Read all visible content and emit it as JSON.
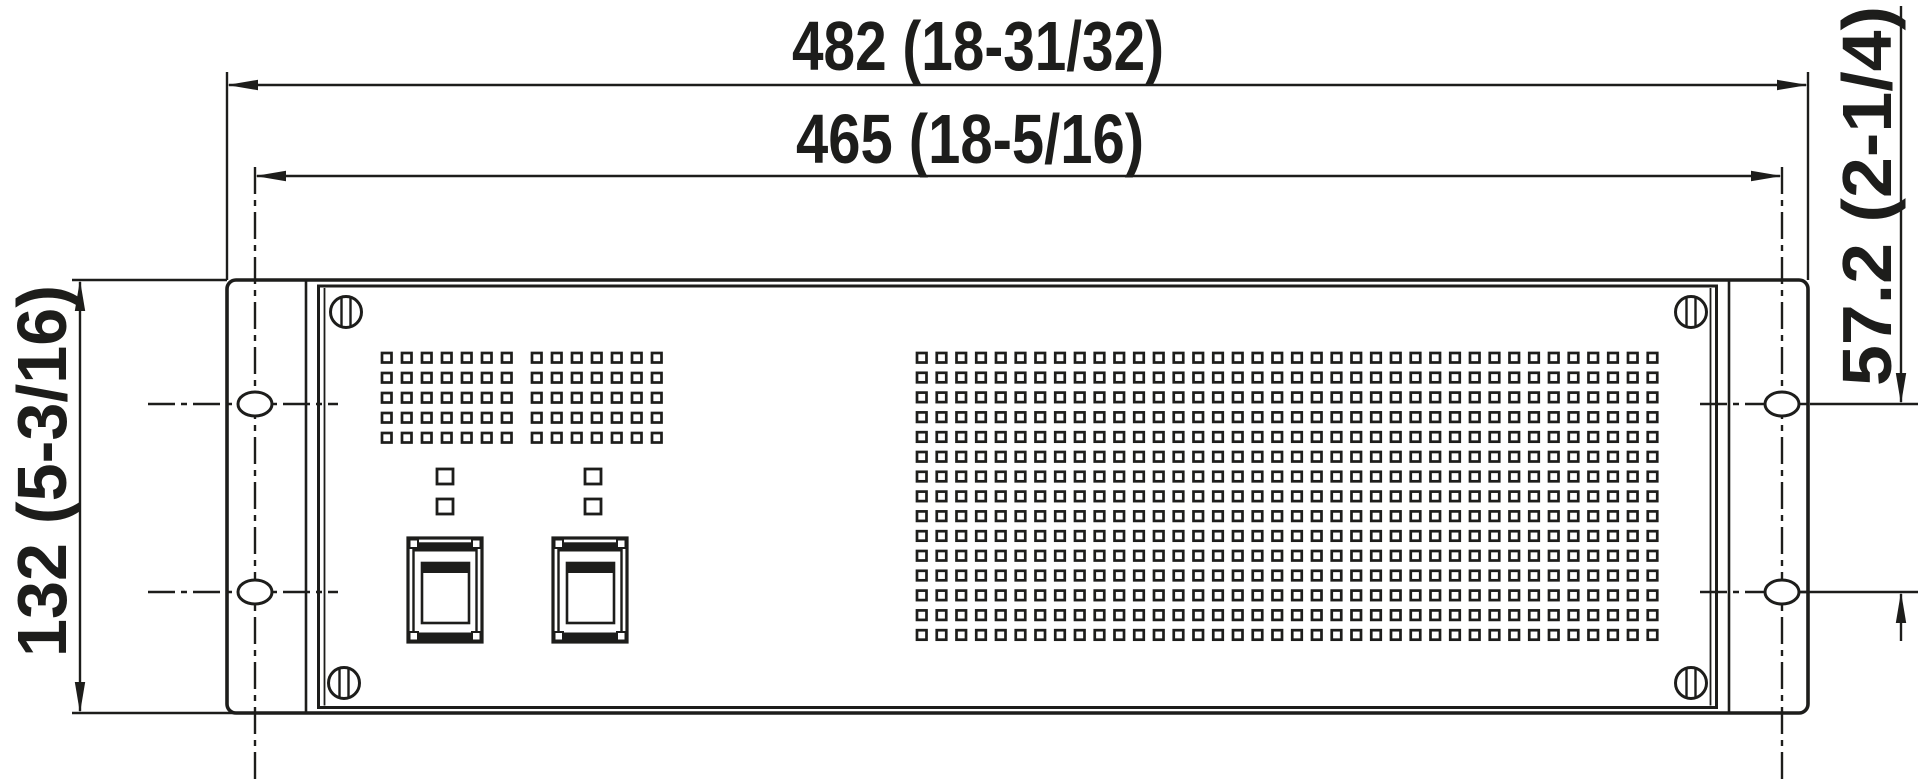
{
  "drawing": {
    "view": "front",
    "background": "#ffffff",
    "ink": "#1d1d1b"
  },
  "dimensions": {
    "overall_width": {
      "label": "482 (18-31/32)",
      "mm": "482",
      "inch": "18-31/32"
    },
    "hole_span_horizontal": {
      "label": "465 (18-5/16)",
      "mm": "465",
      "inch": "18-5/16"
    },
    "overall_height": {
      "label": "132 (5-3/16)",
      "mm": "132",
      "inch": "5-3/16"
    },
    "hole_span_vertical": {
      "label": "57.2 (2-1/4)",
      "mm": "57.2",
      "inch": "2-1/4"
    }
  },
  "panel": {
    "vent_grids": [
      {
        "name": "small-left",
        "cols": 7,
        "rows": 5
      },
      {
        "name": "small-right",
        "cols": 7,
        "rows": 5
      },
      {
        "name": "main",
        "cols": 38,
        "rows": 15
      }
    ],
    "rocker_switches": 2,
    "indicator_cutouts": 4,
    "mounting_slots": 4,
    "panel_screws": 4
  }
}
